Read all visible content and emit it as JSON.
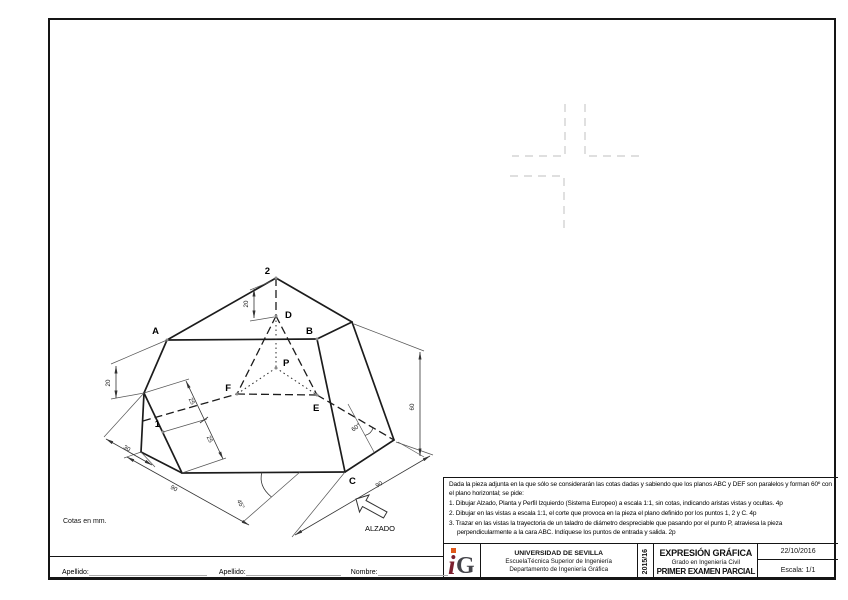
{
  "sheet": {
    "cotas_note": "Cotas en mm.",
    "alzado_label": "ALZADO"
  },
  "drawing": {
    "points": {
      "two": "2",
      "D": "D",
      "A": "A",
      "B": "B",
      "P": "P",
      "F": "F",
      "E": "E",
      "one": "1",
      "C": "C"
    },
    "dims": {
      "height": "60",
      "base_left": "90",
      "base_right": "90",
      "offset_left": "30",
      "angle_base": "45°",
      "angle_right": "60°",
      "seg_a": "25",
      "seg_b": "25",
      "left_h": "20",
      "top_h": "20"
    }
  },
  "instructions": {
    "intro": "Dada la pieza adjunta en la que sólo se considerarán las cotas dadas y sabiendo que los planos ABC y DEF son paralelos y forman 60º con el plano horizontal; se pide:",
    "items": [
      "1. Dibujar Alzado, Planta y Perfil Izquierdo (Sistema Europeo) a escala 1:1, sin cotas, indicando aristas vistas y ocultas. 4p",
      "2. Dibujar en las vistas a escala 1:1, el corte que provoca en la pieza el plano definido por los puntos 1, 2 y C. 4p",
      "3. Trazar en las vistas la trayectoria de un taladro de diámetro despreciable que pasando por el punto P, atraviesa la pieza perpendicularmente a la cara ABC. Indíquese los puntos de entrada y salida. 2p"
    ]
  },
  "title_block": {
    "university": "UNIVERSIDAD DE SEVILLA",
    "school": "EscuelaTécnica Superior de Ingeniería",
    "department": "Departamento de Ingeniería Gráfica",
    "year": "2015/16",
    "subject": "EXPRESIÓN GRÁFICA",
    "degree": "Grado en Ingeniería Civil",
    "exam": "PRIMER EXAMEN PARCIAL",
    "date": "22/10/2016",
    "scale": "Escala: 1/1",
    "logo_i": "i",
    "logo_g": "G",
    "logo_colors": {
      "i": "#7b1f2e",
      "g": "#45454b",
      "dot": "#e0591a"
    }
  },
  "footer": {
    "apellido1": "Apellido:",
    "apellido2": "Apellido:",
    "nombre": "Nombre:"
  }
}
